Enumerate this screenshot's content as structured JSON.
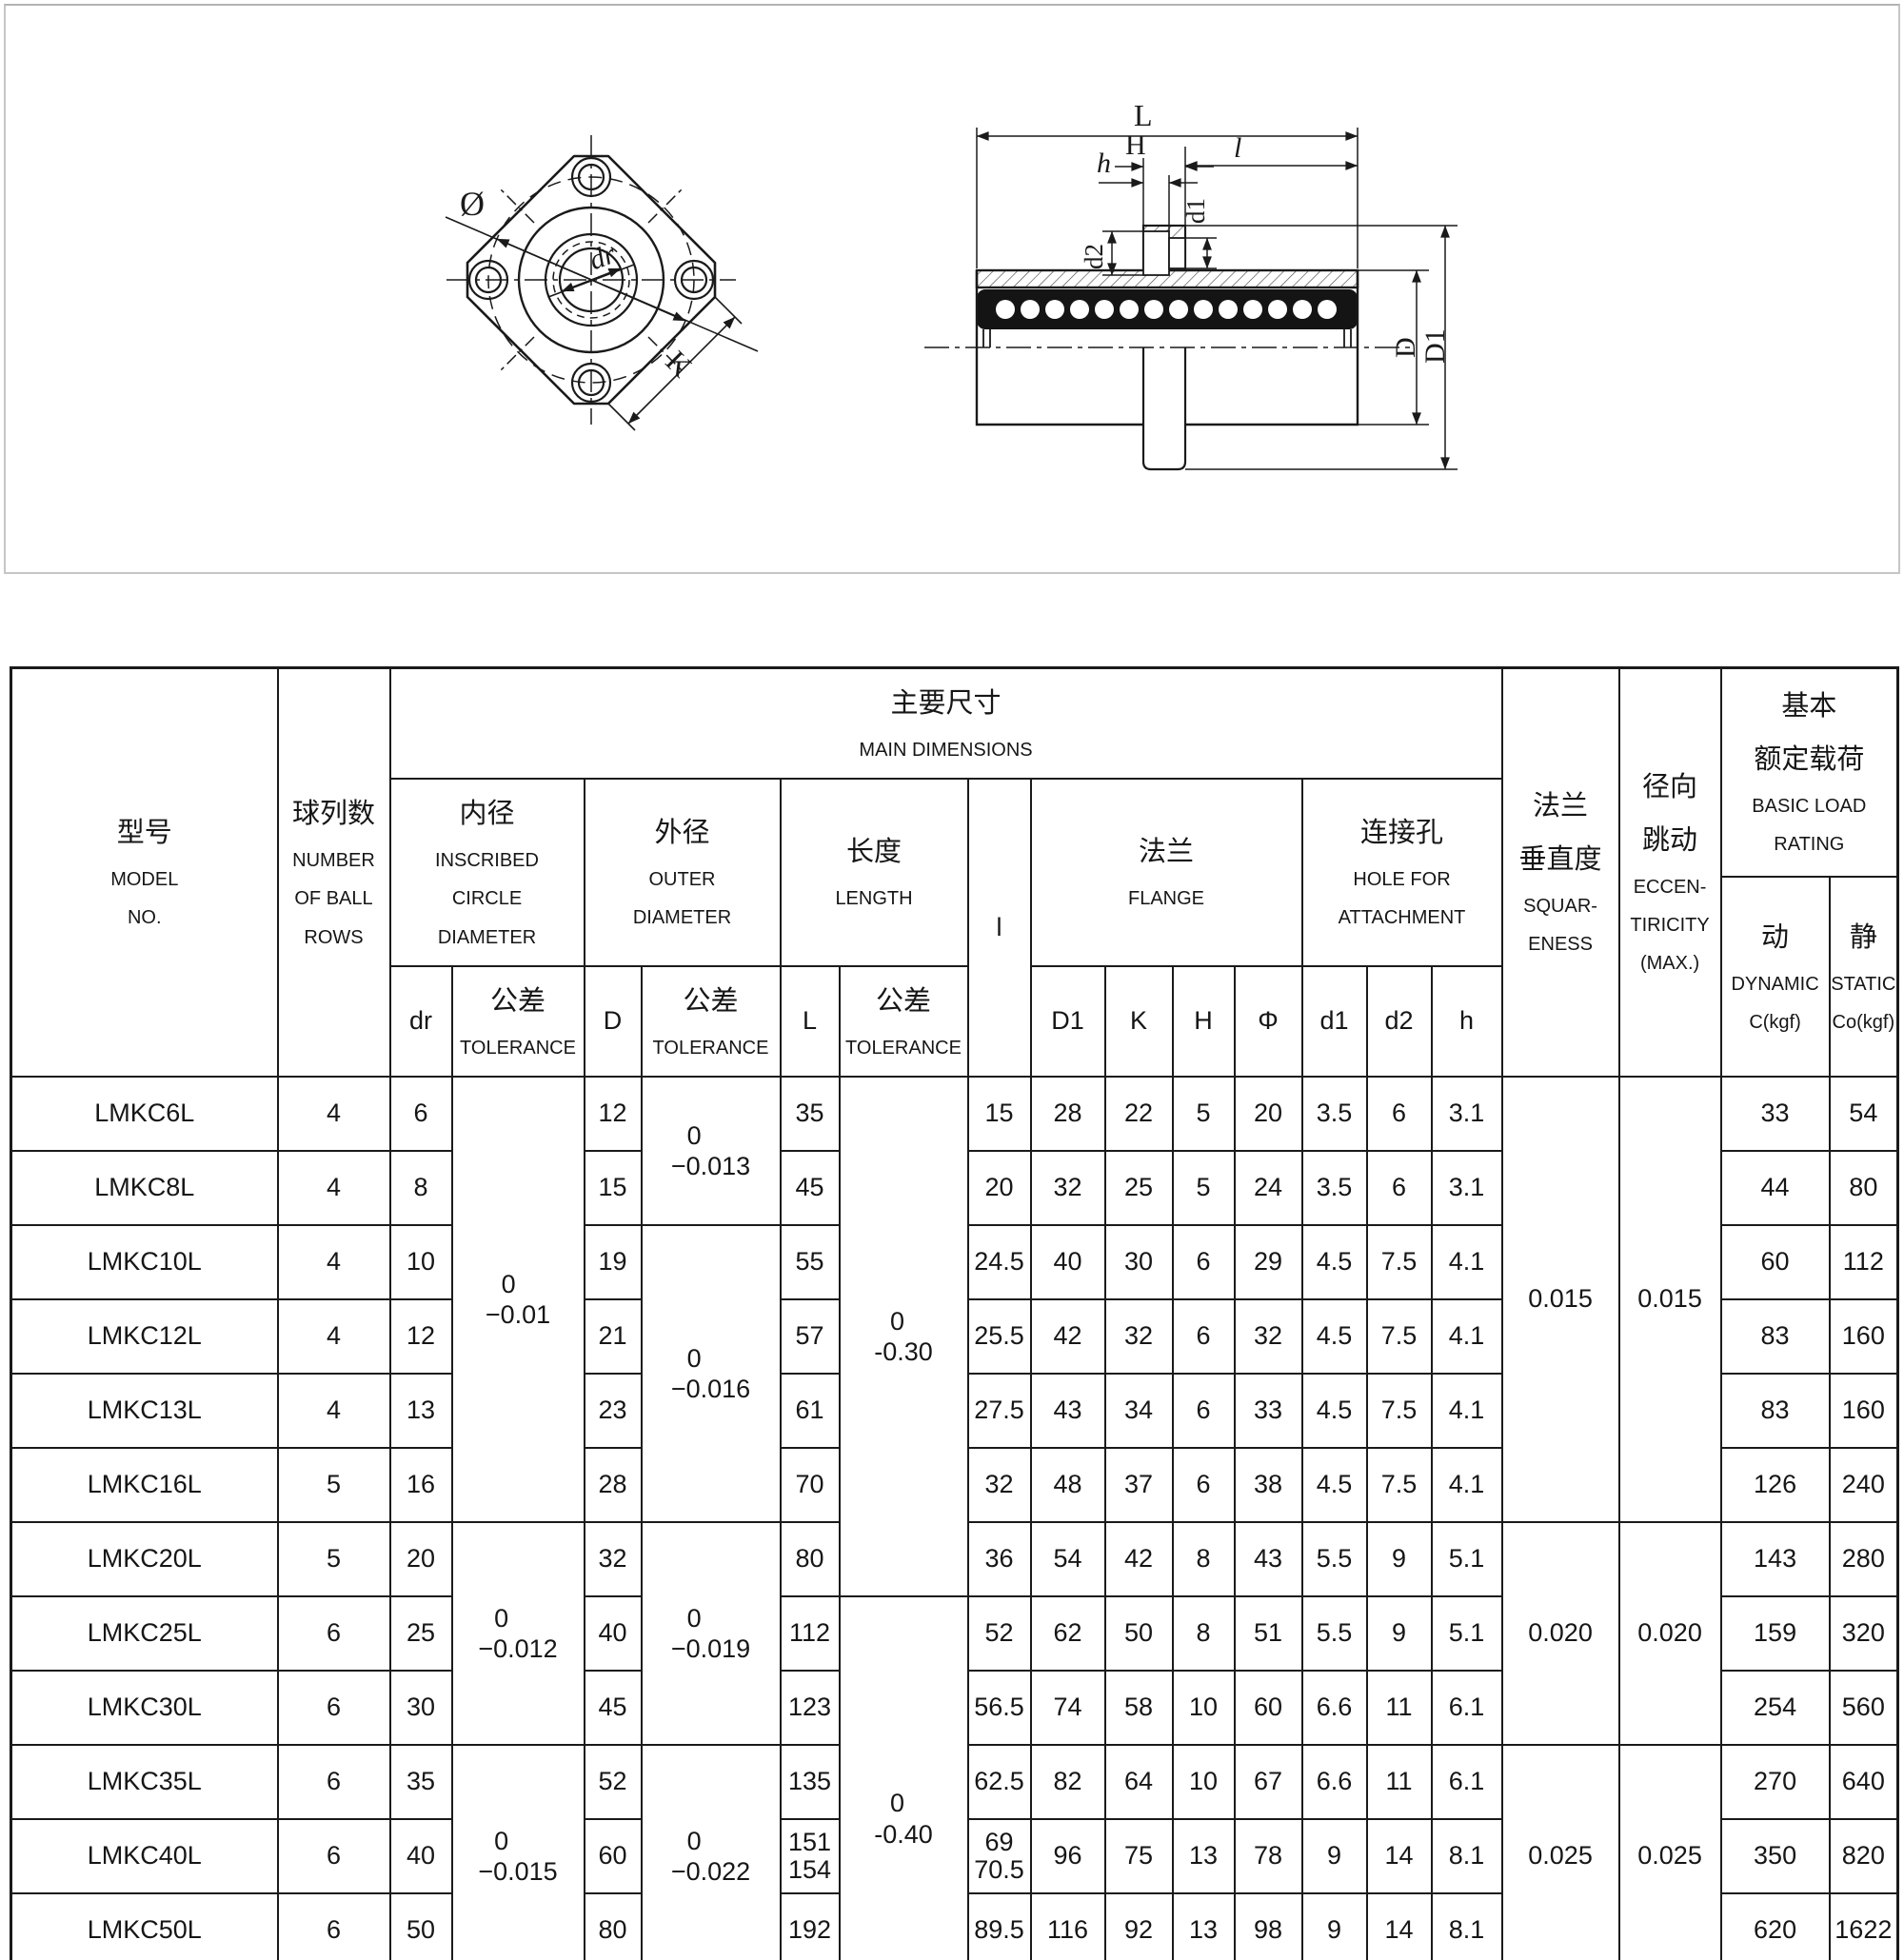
{
  "drawings": {
    "front_view": {
      "labels": {
        "diameter": "Ø",
        "bore": "dr",
        "side": "K"
      }
    },
    "section_view": {
      "labels": {
        "length": "L",
        "flange_thickness": "H",
        "counterbore_depth": "h",
        "sleeve_length": "l",
        "hole_diameter": "d1",
        "counterbore_diameter": "d2",
        "outer_diameter": "D",
        "flange_diameter": "D1"
      }
    }
  },
  "table": {
    "header": {
      "model": {
        "zh": "型号",
        "en": [
          "MODEL",
          "NO."
        ]
      },
      "ball_rows": {
        "zh": "球列数",
        "en": [
          "NUMBER",
          "OF BALL",
          "ROWS"
        ]
      },
      "main_dimensions": {
        "zh": "主要尺寸",
        "en": "MAIN DIMENSIONS"
      },
      "inscribed": {
        "zh": "内径",
        "en": [
          "INSCRIBED",
          "CIRCLE",
          "DIAMETER"
        ]
      },
      "outer": {
        "zh": "外径",
        "en": [
          "OUTER",
          "DIAMETER"
        ]
      },
      "length": {
        "zh": "长度",
        "en": [
          "LENGTH"
        ]
      },
      "l": "l",
      "flange": {
        "zh": "法兰",
        "en": "FLANGE"
      },
      "hole": {
        "zh": "连接孔",
        "en": [
          "HOLE FOR",
          "ATTACHMENT"
        ]
      },
      "squareness": {
        "zh": [
          "法兰",
          "垂直度"
        ],
        "en": [
          "SQUAR-",
          "ENESS"
        ]
      },
      "eccentricity": {
        "zh": [
          "径向",
          "跳动"
        ],
        "en": [
          "ECCEN-",
          "TIRICITY",
          "(MAX.)"
        ]
      },
      "rating": {
        "zh": [
          "基本",
          "额定载荷"
        ],
        "en": [
          "BASIC LOAD",
          "RATING"
        ]
      },
      "dynamic": {
        "zh": "动",
        "en": "DYNAMIC",
        "unit": "C(kgf)"
      },
      "static": {
        "zh": "静",
        "en": "STATIC",
        "unit": "Co(kgf)"
      },
      "sub": {
        "dr": "dr",
        "tol_zh": "公差",
        "tol_en": "TOLERANCE",
        "D": "D",
        "L": "L",
        "D1": "D1",
        "K": "K",
        "H": "H",
        "phi": "Φ",
        "d1": "d1",
        "d2": "d2",
        "h": "h"
      }
    },
    "rows": [
      {
        "model": "LMKC6L",
        "balls": "4",
        "dr": "6",
        "D": "12",
        "L": "35",
        "l": "15",
        "D1": "28",
        "K": "22",
        "H": "5",
        "phi": "20",
        "d1": "3.5",
        "d2": "6",
        "h": "3.1",
        "dynamic": "33",
        "static": "54"
      },
      {
        "model": "LMKC8L",
        "balls": "4",
        "dr": "8",
        "D": "15",
        "L": "45",
        "l": "20",
        "D1": "32",
        "K": "25",
        "H": "5",
        "phi": "24",
        "d1": "3.5",
        "d2": "6",
        "h": "3.1",
        "dynamic": "44",
        "static": "80"
      },
      {
        "model": "LMKC10L",
        "balls": "4",
        "dr": "10",
        "D": "19",
        "L": "55",
        "l": "24.5",
        "D1": "40",
        "K": "30",
        "H": "6",
        "phi": "29",
        "d1": "4.5",
        "d2": "7.5",
        "h": "4.1",
        "dynamic": "60",
        "static": "112"
      },
      {
        "model": "LMKC12L",
        "balls": "4",
        "dr": "12",
        "D": "21",
        "L": "57",
        "l": "25.5",
        "D1": "42",
        "K": "32",
        "H": "6",
        "phi": "32",
        "d1": "4.5",
        "d2": "7.5",
        "h": "4.1",
        "dynamic": "83",
        "static": "160"
      },
      {
        "model": "LMKC13L",
        "balls": "4",
        "dr": "13",
        "D": "23",
        "L": "61",
        "l": "27.5",
        "D1": "43",
        "K": "34",
        "H": "6",
        "phi": "33",
        "d1": "4.5",
        "d2": "7.5",
        "h": "4.1",
        "dynamic": "83",
        "static": "160"
      },
      {
        "model": "LMKC16L",
        "balls": "5",
        "dr": "16",
        "D": "28",
        "L": "70",
        "l": "32",
        "D1": "48",
        "K": "37",
        "H": "6",
        "phi": "38",
        "d1": "4.5",
        "d2": "7.5",
        "h": "4.1",
        "dynamic": "126",
        "static": "240"
      },
      {
        "model": "LMKC20L",
        "balls": "5",
        "dr": "20",
        "D": "32",
        "L": "80",
        "l": "36",
        "D1": "54",
        "K": "42",
        "H": "8",
        "phi": "43",
        "d1": "5.5",
        "d2": "9",
        "h": "5.1",
        "dynamic": "143",
        "static": "280"
      },
      {
        "model": "LMKC25L",
        "balls": "6",
        "dr": "25",
        "D": "40",
        "L": "112",
        "l": "52",
        "D1": "62",
        "K": "50",
        "H": "8",
        "phi": "51",
        "d1": "5.5",
        "d2": "9",
        "h": "5.1",
        "dynamic": "159",
        "static": "320"
      },
      {
        "model": "LMKC30L",
        "balls": "6",
        "dr": "30",
        "D": "45",
        "L": "123",
        "l": "56.5",
        "D1": "74",
        "K": "58",
        "H": "10",
        "phi": "60",
        "d1": "6.6",
        "d2": "11",
        "h": "6.1",
        "dynamic": "254",
        "static": "560"
      },
      {
        "model": "LMKC35L",
        "balls": "6",
        "dr": "35",
        "D": "52",
        "L": "135",
        "l": "62.5",
        "D1": "82",
        "K": "64",
        "H": "10",
        "phi": "67",
        "d1": "6.6",
        "d2": "11",
        "h": "6.1",
        "dynamic": "270",
        "static": "640"
      },
      {
        "model": "LMKC40L",
        "balls": "6",
        "dr": "40",
        "D": "60",
        "L": "151\n154",
        "l": "69\n70.5",
        "D1": "96",
        "K": "75",
        "H": "13",
        "phi": "78",
        "d1": "9",
        "d2": "14",
        "h": "8.1",
        "dynamic": "350",
        "static": "820"
      },
      {
        "model": "LMKC50L",
        "balls": "6",
        "dr": "50",
        "D": "80",
        "L": "192",
        "l": "89.5",
        "D1": "116",
        "K": "92",
        "H": "13",
        "phi": "98",
        "d1": "9",
        "d2": "14",
        "h": "8.1",
        "dynamic": "620",
        "static": "1622"
      },
      {
        "model": "LMKC60L",
        "balls": "6",
        "dr": "60",
        "D": "90",
        "L": "209",
        "l": "95.5",
        "D1": "134",
        "K": "106",
        "H": "18",
        "phi": "112",
        "d1": "11",
        "d2": "17.5",
        "h": "11.1",
        "dynamic": "770",
        "static": "2040"
      }
    ],
    "merges": {
      "dr_tol": [
        {
          "from": 0,
          "to": 5,
          "lines": [
            "0",
            "−0.01"
          ]
        },
        {
          "from": 6,
          "to": 8,
          "lines": [
            "0",
            "−0.012"
          ]
        },
        {
          "from": 9,
          "to": 11,
          "lines": [
            "0",
            "−0.015"
          ]
        },
        {
          "from": 12,
          "to": 12,
          "lines": [
            "0",
            "−0.020"
          ]
        }
      ],
      "d_tol": [
        {
          "from": 0,
          "to": 1,
          "lines": [
            "0",
            "−0.013"
          ]
        },
        {
          "from": 2,
          "to": 5,
          "lines": [
            "0",
            "−0.016"
          ]
        },
        {
          "from": 6,
          "to": 8,
          "lines": [
            "0",
            "−0.019"
          ]
        },
        {
          "from": 9,
          "to": 11,
          "lines": [
            "0",
            "−0.022"
          ]
        },
        {
          "from": 12,
          "to": 12,
          "lines": [
            "0",
            "−0.025"
          ]
        }
      ],
      "l_tol": [
        {
          "from": 0,
          "to": 6,
          "lines": [
            "0",
            "-0.30"
          ]
        },
        {
          "from": 7,
          "to": 12,
          "lines": [
            "0",
            "-0.40"
          ]
        }
      ],
      "squareness": [
        {
          "from": 0,
          "to": 5,
          "value": "0.015"
        },
        {
          "from": 6,
          "to": 8,
          "value": "0.020"
        },
        {
          "from": 9,
          "to": 11,
          "value": "0.025"
        },
        {
          "from": 12,
          "to": 12,
          "value": "0.030"
        }
      ],
      "eccentricity": [
        {
          "from": 0,
          "to": 5,
          "value": "0.015"
        },
        {
          "from": 6,
          "to": 8,
          "value": "0.020"
        },
        {
          "from": 9,
          "to": 11,
          "value": "0.025"
        },
        {
          "from": 12,
          "to": 12,
          "value": "0.030"
        }
      ]
    }
  }
}
